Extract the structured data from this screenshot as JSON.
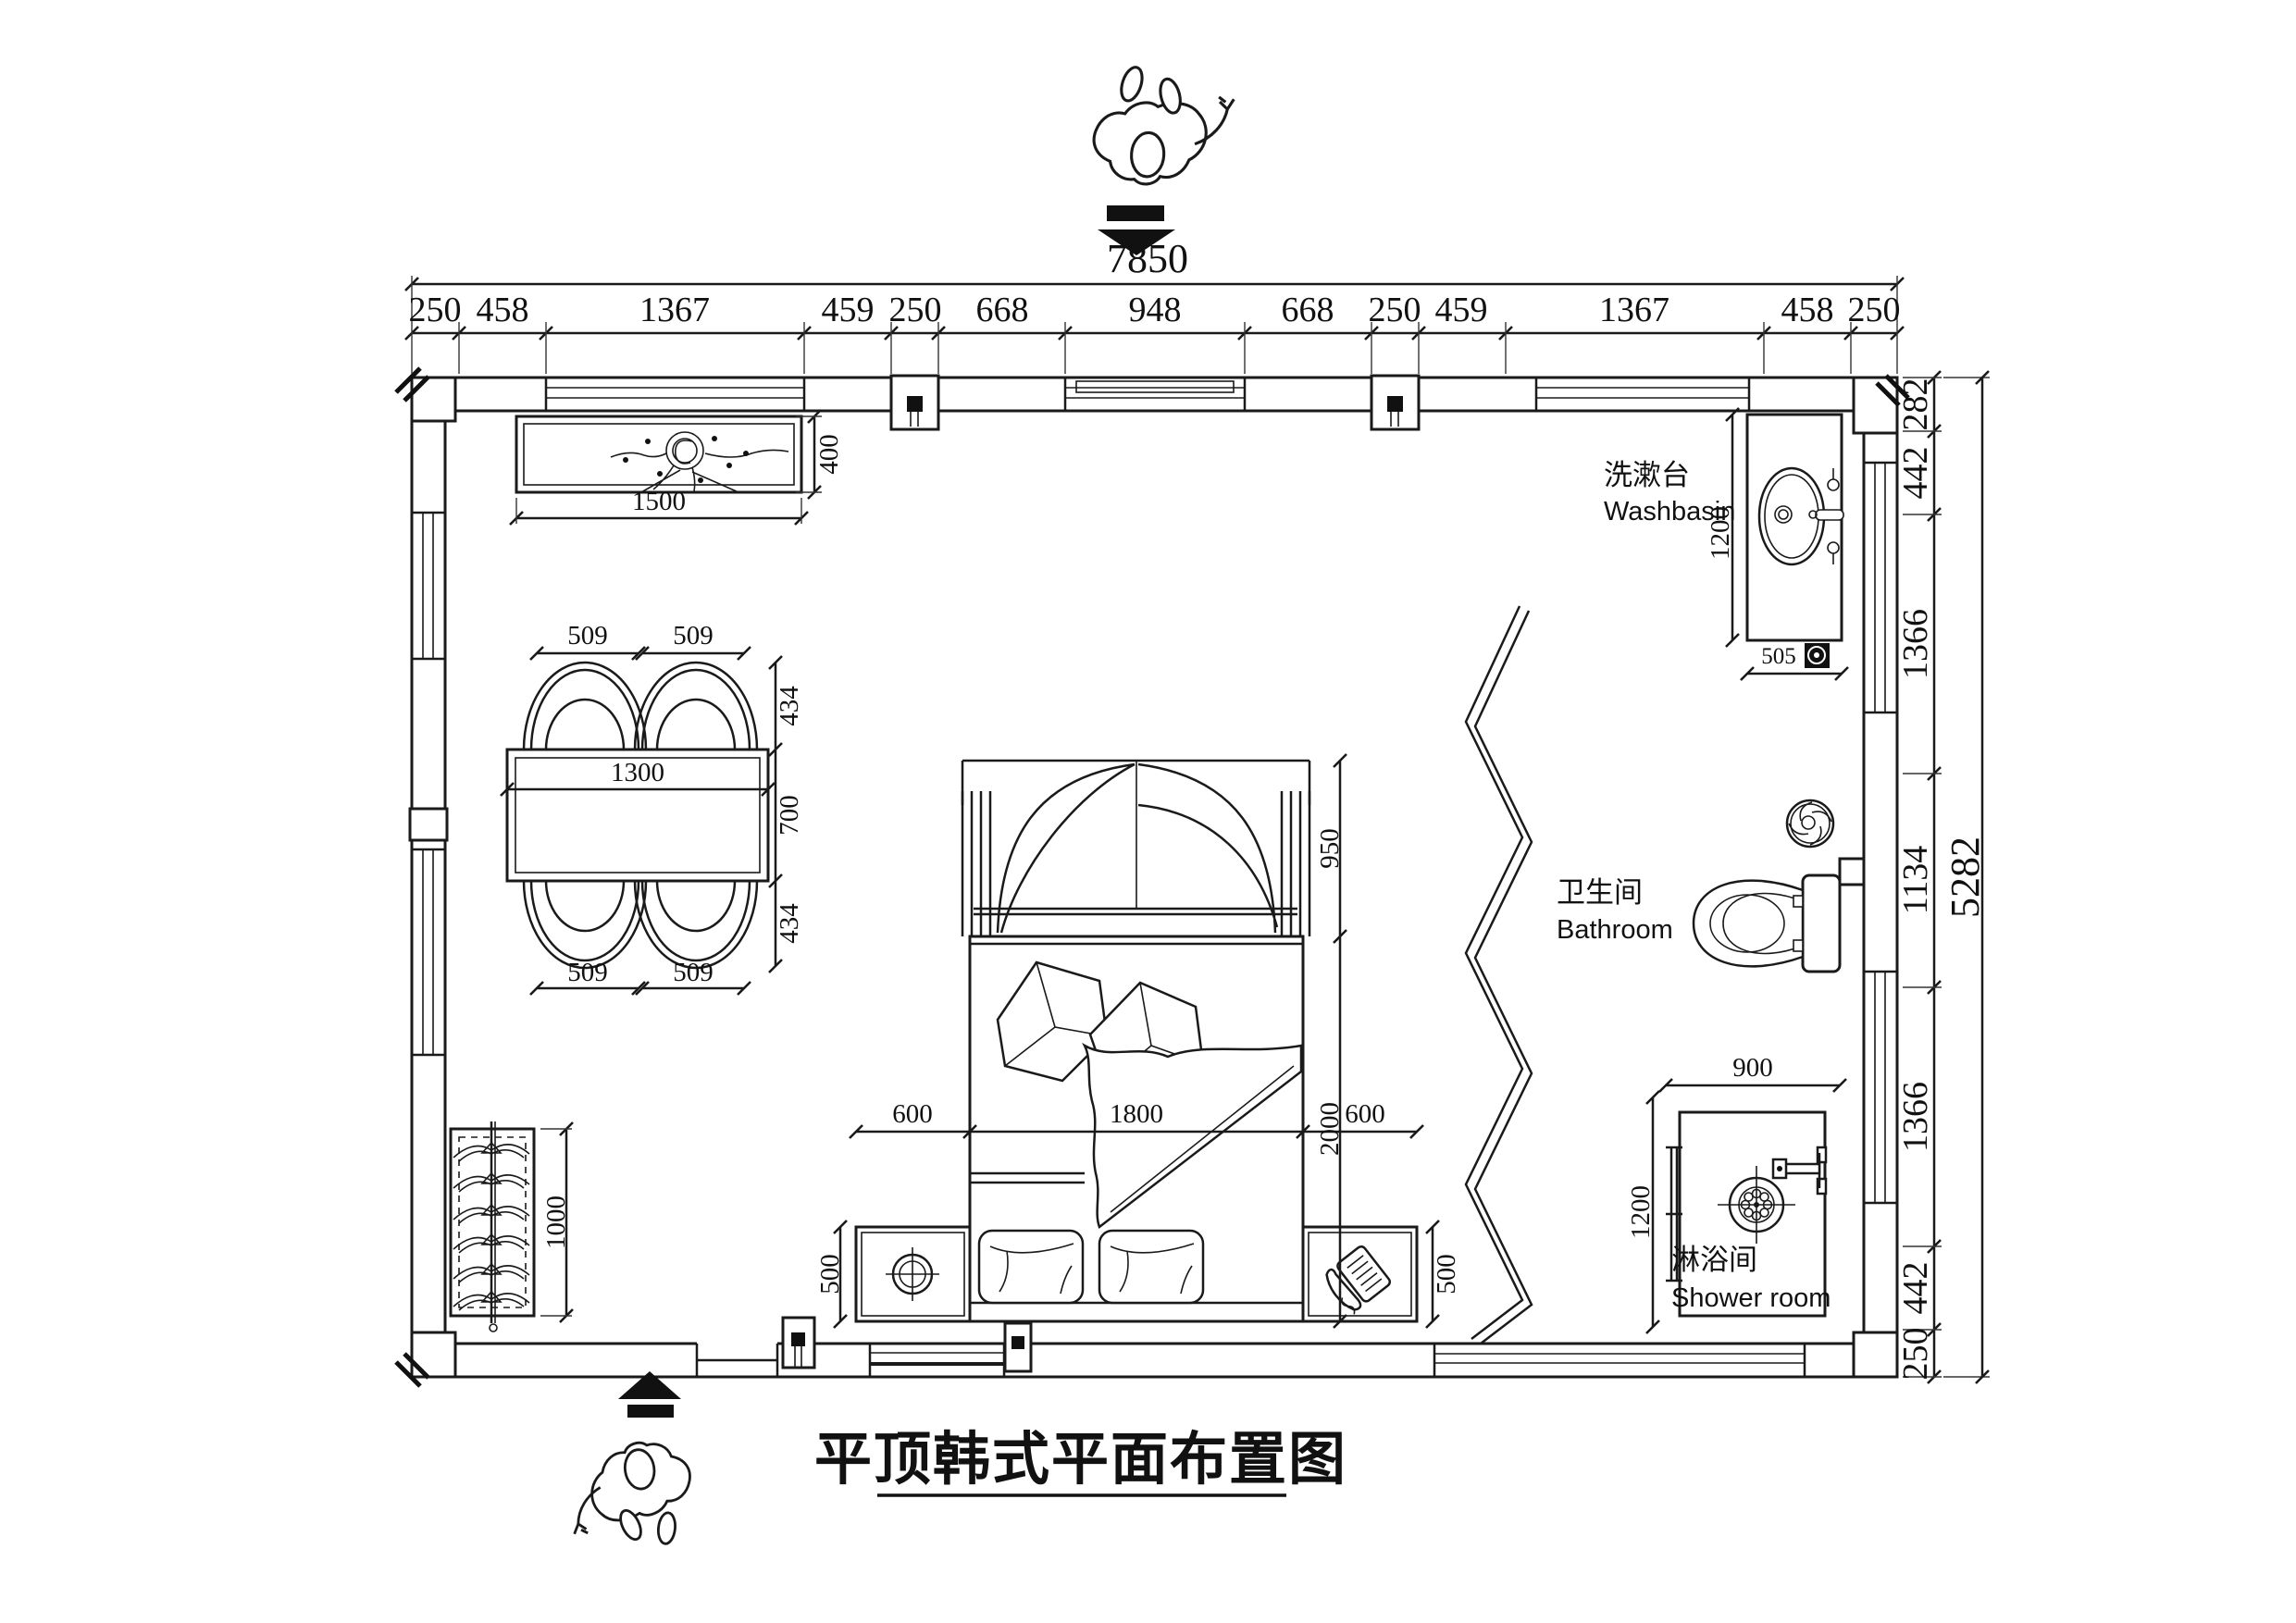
{
  "title": {
    "text": "平顶韩式平面布置图"
  },
  "overall_dims": {
    "width_total": "7850",
    "height_total": "5282"
  },
  "top_chain": {
    "segments": [
      "250",
      "458",
      "1367",
      "459",
      "250",
      "668",
      "948",
      "668",
      "250",
      "459",
      "1367",
      "458",
      "250"
    ]
  },
  "right_chain": {
    "segments": [
      "282",
      "442",
      "1366",
      "1134",
      "1366",
      "442",
      "250"
    ]
  },
  "rooms": {
    "washbasin": {
      "zh": "洗漱台",
      "en": "Washbasin"
    },
    "bathroom": {
      "zh": "卫生间",
      "en": "Bathroom"
    },
    "shower": {
      "zh": "淋浴间",
      "en": "Shower room"
    }
  },
  "dims": {
    "counter_width": "1500",
    "counter_depth": "400",
    "chair_pitch": "509",
    "chair_depth": "434",
    "table_width": "1300",
    "table_depth": "700",
    "wardrobe_len": "1000",
    "canopy_depth": "950",
    "bed_len": "2000",
    "bed_width": "1800",
    "bed_side": "600",
    "nightstand_depth": "500",
    "basin_counter_len": "1200",
    "basin_counter_width": "505",
    "shower_width": "900",
    "shower_depth": "1200"
  }
}
